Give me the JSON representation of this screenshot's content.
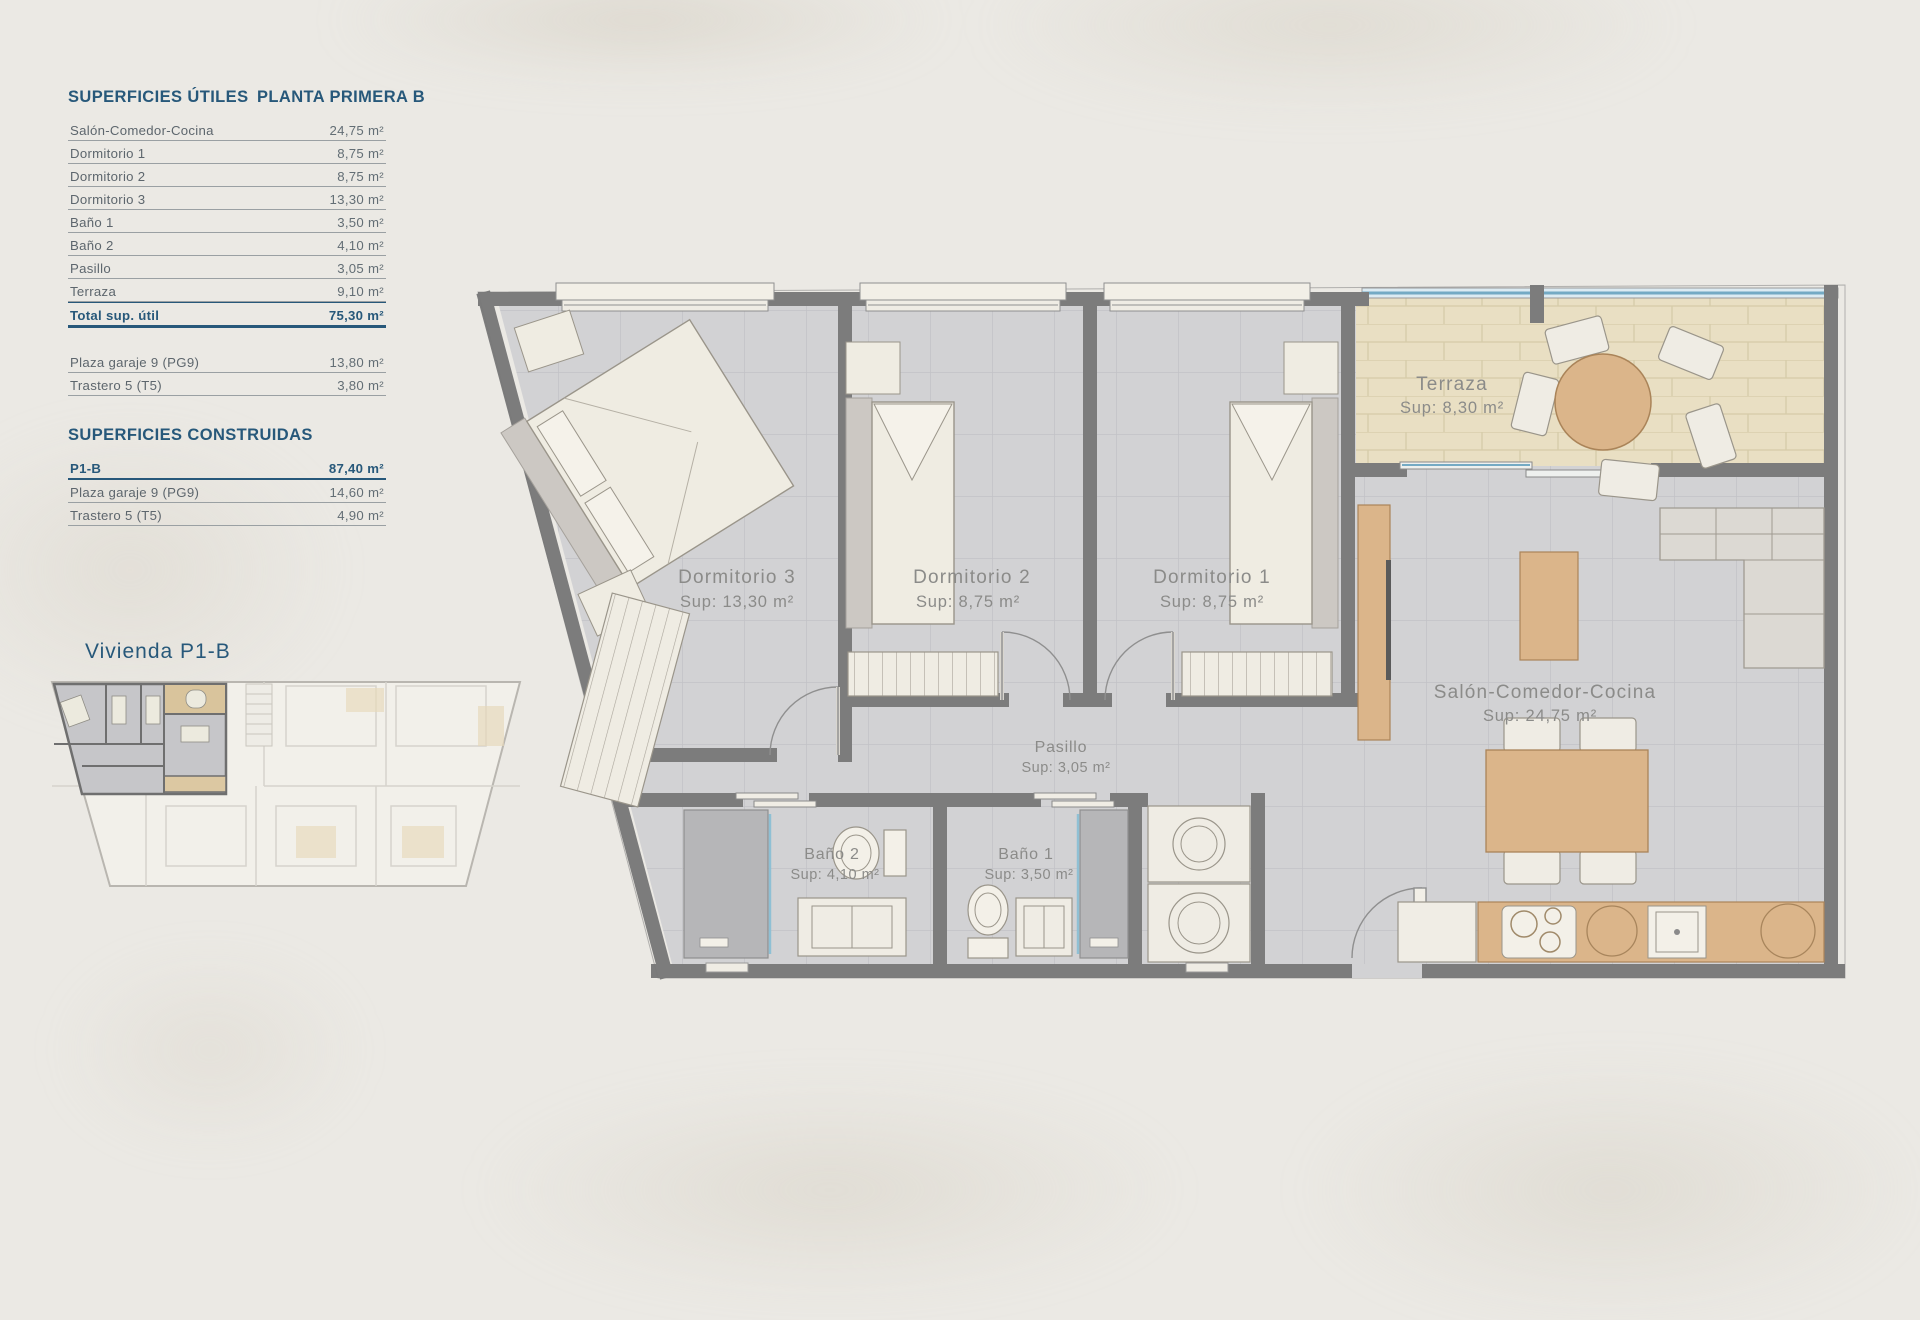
{
  "page": {
    "background": "#ebe9e4",
    "accent_navy": "#27587a",
    "text_gray": "#5d666d",
    "plan_label_gray": "#8b8b89",
    "wall_gray": "#7c7c7c",
    "floor_gray": "#d2d2d4",
    "terrace_beige": "#e9dfc3",
    "wood": "#dbb58a",
    "glass_blue": "#74aac4"
  },
  "tables": {
    "utiles": {
      "title": "SUPERFICIES ÚTILES",
      "subtitle": "PLANTA PRIMERA B",
      "rows": [
        {
          "label": "Salón-Comedor-Cocina",
          "value": "24,75 m²"
        },
        {
          "label": "Dormitorio 1",
          "value": "8,75 m²"
        },
        {
          "label": "Dormitorio 2",
          "value": "8,75 m²"
        },
        {
          "label": "Dormitorio 3",
          "value": "13,30 m²"
        },
        {
          "label": "Baño 1",
          "value": "3,50 m²"
        },
        {
          "label": "Baño 2",
          "value": "4,10 m²"
        },
        {
          "label": "Pasillo",
          "value": "3,05 m²"
        },
        {
          "label": "Terraza",
          "value": "9,10 m²"
        }
      ],
      "total": {
        "label": "Total sup. útil",
        "value": "75,30 m²"
      },
      "extra_rows": [
        {
          "label": "Plaza garaje 9 (PG9)",
          "value": "13,80 m²"
        },
        {
          "label": "Trastero 5 (T5)",
          "value": "3,80 m²"
        }
      ]
    },
    "construidas": {
      "title": "SUPERFICIES CONSTRUIDAS",
      "rows": [
        {
          "label": "P1-B",
          "value": "87,40 m²"
        },
        {
          "label": "Plaza garaje 9 (PG9)",
          "value": "14,60 m²"
        },
        {
          "label": "Trastero 5 (T5)",
          "value": "4,90 m²"
        }
      ]
    }
  },
  "key_plan": {
    "label": "Vivienda P1-B"
  },
  "floor_plan": {
    "rooms": [
      {
        "name": "Dormitorio 3",
        "sup": "Sup: 13,30 m²"
      },
      {
        "name": "Dormitorio 2",
        "sup": "Sup: 8,75 m²"
      },
      {
        "name": "Dormitorio 1",
        "sup": "Sup: 8,75 m²"
      },
      {
        "name": "Terraza",
        "sup": "Sup: 8,30 m²"
      },
      {
        "name": "Salón-Comedor-Cocina",
        "sup": "Sup: 24,75 m²"
      },
      {
        "name": "Pasillo",
        "sup": "Sup: 3,05 m²"
      },
      {
        "name": "Baño 2",
        "sup": "Sup: 4,10 m²"
      },
      {
        "name": "Baño 1",
        "sup": "Sup: 3,50 m²"
      }
    ]
  }
}
